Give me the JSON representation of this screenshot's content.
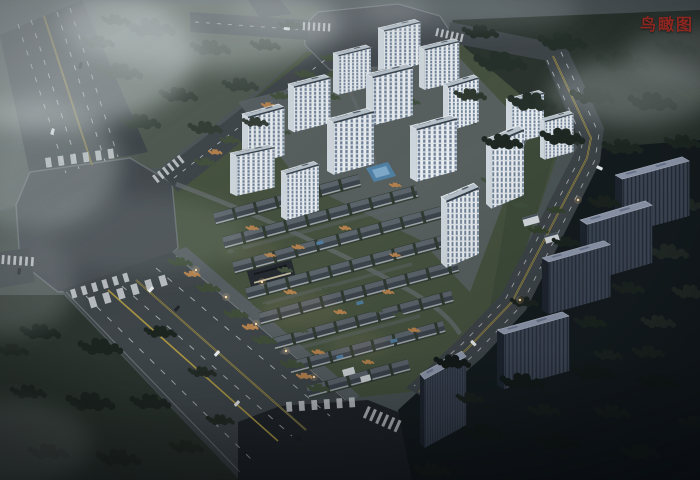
{
  "annotation": {
    "label": "鸟瞰图"
  },
  "palette": {
    "label-color": "#8e2620",
    "road-surface": "#3e4549",
    "plaza-surface": "#43494e",
    "greenery": "#46523f",
    "forest-dark": "#2b342f",
    "night-ground": "#151c1f",
    "pool-water": "#5181a6",
    "lane-white": "#c9ced2",
    "lane-yellow": "#a89543",
    "fog": "#ccd3d6",
    "tower-roof": "#b6c1c9",
    "tower-facade": "#edf1f3",
    "dark-building": "#3a4351",
    "villa-roof": "#434b53",
    "autumn-tree": "#b27a45"
  }
}
